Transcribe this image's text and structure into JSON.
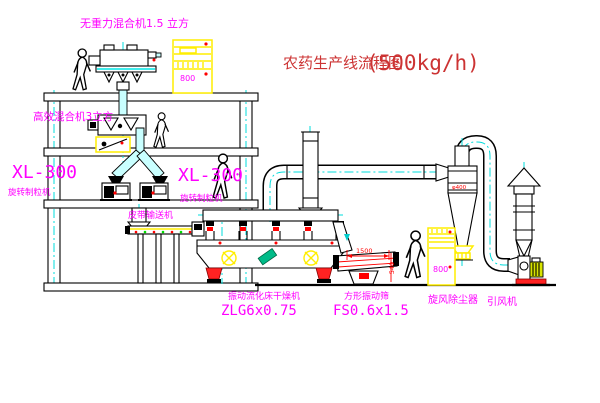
{
  "title": {
    "cn": "农药生产线流程图",
    "capacity": "(500kg/h)"
  },
  "labels": {
    "top_mixer": "无重力混合机1.5 立方",
    "floor2_mixer": "高效混合机3立方",
    "granulator_model_left": "XL-300",
    "granulator_name_left": "旋转制粒机",
    "granulator_model_right": "XL-300",
    "granulator_name_right": "旋转制粒机",
    "belt_conveyor": "皮带输送机",
    "dryer_name": "振动流化床干燥机",
    "dryer_model": "ZLG6x0.75",
    "screen_name": "方形振动筛",
    "screen_model": "FS0.6x1.5",
    "cyclone": "旋风除尘器",
    "fan": "引风机"
  },
  "dimensions": {
    "screen_length": "1500",
    "screen_height": "540",
    "cyclone_diameter": "φ400"
  },
  "cabinets": {
    "cabinet1_text": "800",
    "cabinet2_text": "800"
  },
  "colors": {
    "background": "#ffffff",
    "line": "#000000",
    "centerline_cyan": "#00dcdc",
    "label_magenta": "#ff00ff",
    "title_red": "#cc3333",
    "highlight_yellow": "#ffee00",
    "alert_red": "#ff0000",
    "green_dot": "#00dd00",
    "teal_plate": "#00bb88"
  }
}
